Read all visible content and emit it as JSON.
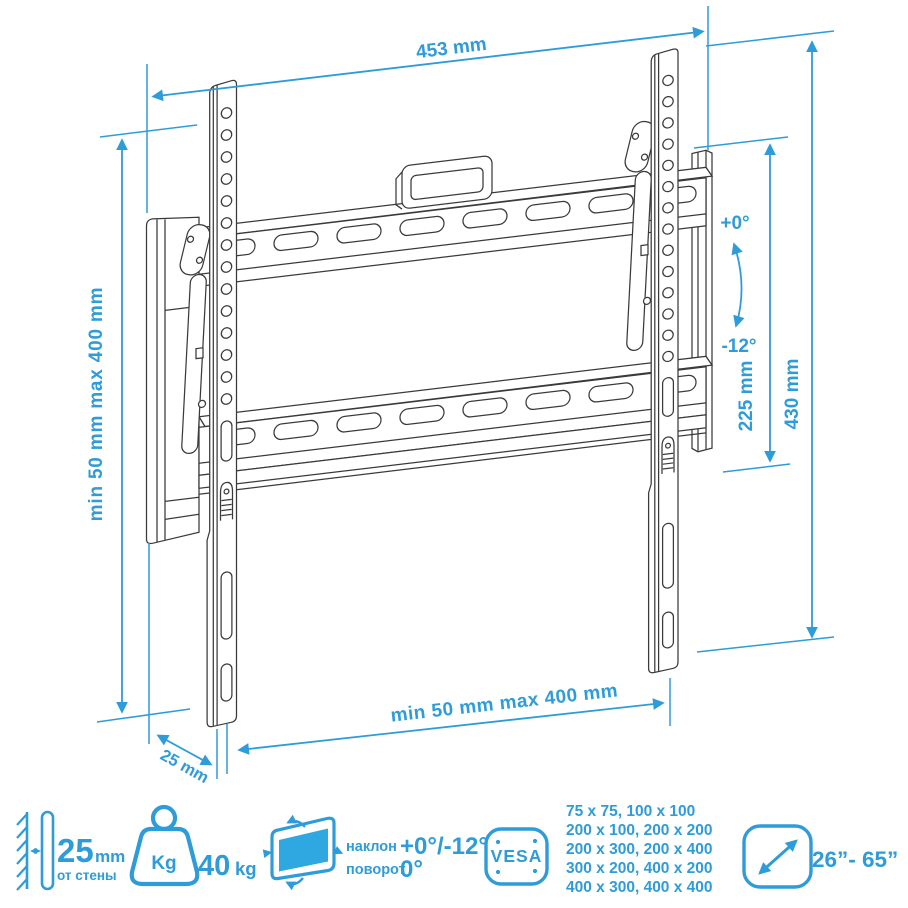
{
  "diagram": {
    "width_label": "453 mm",
    "left_range_label": "min 50 mm max 400 mm",
    "inner_height_label": "225 mm",
    "outer_height_label": "430 mm",
    "tilt_plus_label": "+0°",
    "tilt_minus_label": "-12°",
    "bottom_range_label": "min 50 mm max 400 mm",
    "depth_label": "25 mm"
  },
  "specs": {
    "wall_distance": {
      "value": "25",
      "unit": "mm",
      "caption": "от стены"
    },
    "max_weight": {
      "badge": "Kg",
      "value": "40",
      "unit": "kg"
    },
    "tilt": {
      "row1_label": "наклон",
      "row1_value": "+0°/-12°",
      "row2_label": "поворот",
      "row2_value": "0°"
    },
    "vesa": {
      "badge": "VESA",
      "sizes": [
        "75 x 75, 100 x 100",
        "200 x 100, 200 x 200",
        "200 x 300, 200 x 400",
        "300 x 200, 400 x 200",
        "400 x 300, 400 x 400"
      ]
    },
    "screen_size": {
      "value": "26”- 65”"
    }
  },
  "colors": {
    "accent": "#2E9CD9",
    "line_art": "#3a3a3a",
    "screen_fill": "#2FA7E1"
  }
}
